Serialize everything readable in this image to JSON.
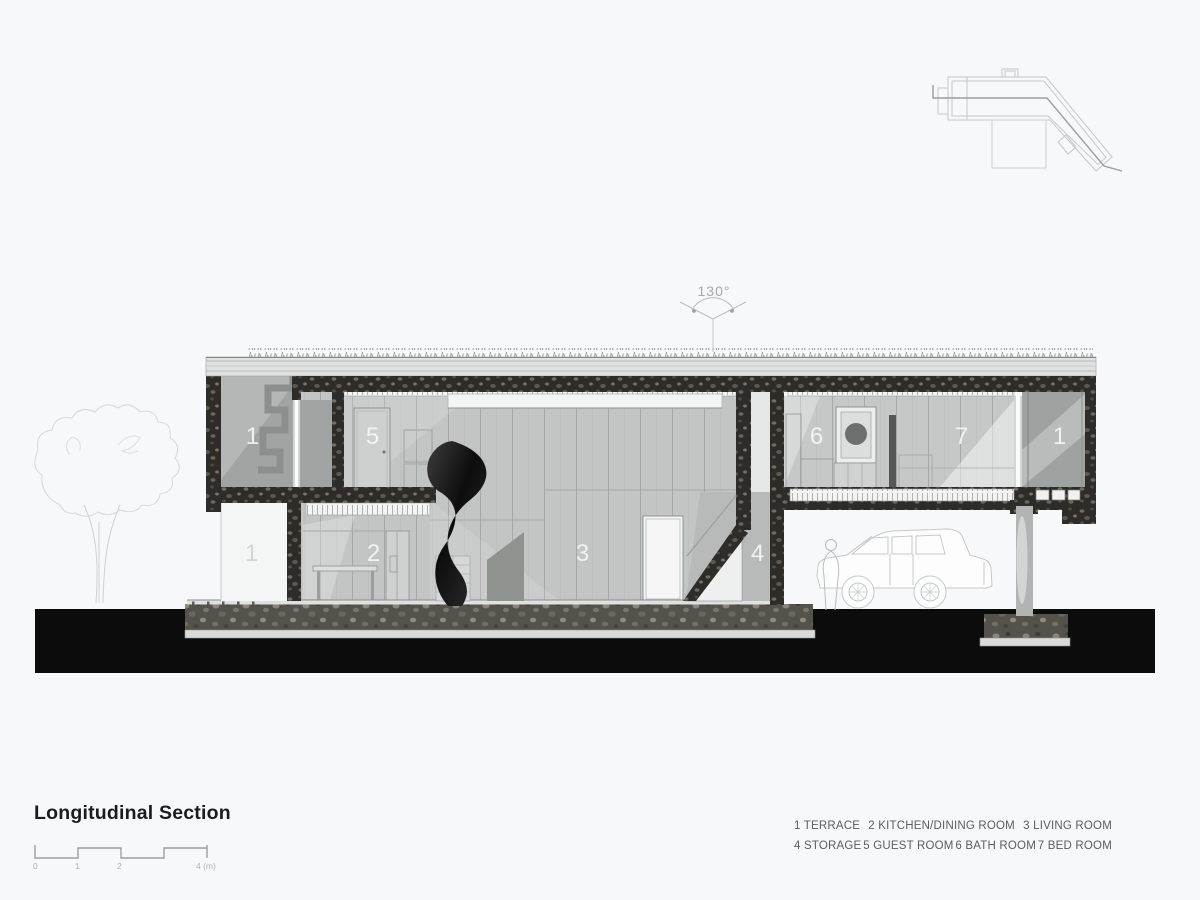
{
  "drawing": {
    "title": "Longitudinal Section",
    "angle_annotation": "130°",
    "scale_bar": {
      "tick_labels": [
        "0",
        "1",
        "2",
        "4 (m)"
      ]
    },
    "room_labels": [
      {
        "room": "terrace-upper-left",
        "text": "1"
      },
      {
        "room": "guest-room",
        "text": "5"
      },
      {
        "room": "bath-room",
        "text": "6"
      },
      {
        "room": "bed-room",
        "text": "7"
      },
      {
        "room": "terrace-upper-right",
        "text": "1"
      },
      {
        "room": "terrace-lower-left",
        "text": "1"
      },
      {
        "room": "kitchen-dining-room",
        "text": "2"
      },
      {
        "room": "living-room",
        "text": "3"
      },
      {
        "room": "storage",
        "text": "4"
      }
    ],
    "legend": {
      "row1": [
        "1 TERRACE",
        "2 KITCHEN/DINING ROOM",
        "3 LIVING ROOM"
      ],
      "row2": [
        "4 STORAGE",
        "5 GUEST ROOM",
        "6 BATH ROOM",
        "7 BED ROOM"
      ]
    },
    "colors": {
      "background": "#f6f8f9",
      "ground_black": "#0c0c0c",
      "cut_wall_dark": "#2d2c29",
      "foundation_gravel": "#55524b",
      "wall_panel_gray": "#c2c5c3",
      "terrace_gray": "#a0a4a2",
      "room_label_text": "#f2f4f3",
      "title_text": "#1c1c1c",
      "legend_text": "#5b5e5d",
      "line_light": "#c4c9ca"
    }
  }
}
